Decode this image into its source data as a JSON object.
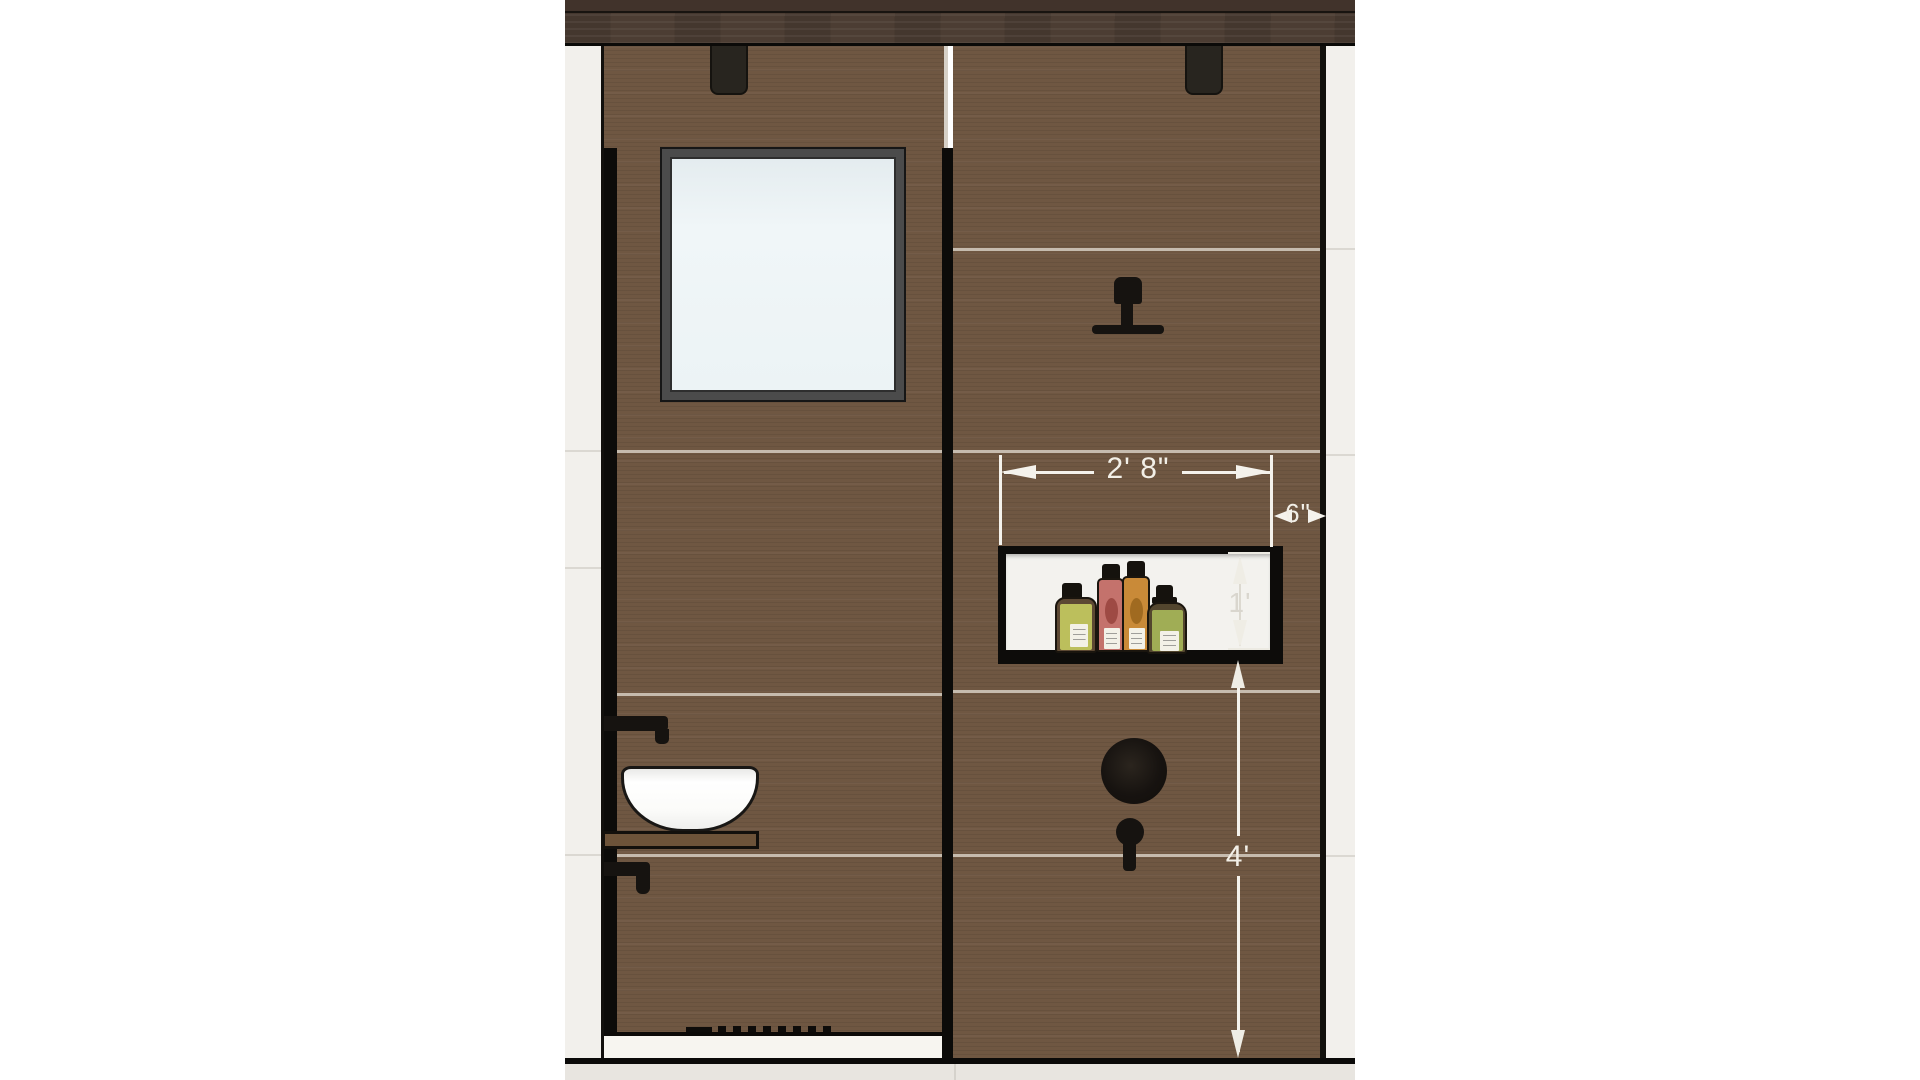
{
  "drawing": {
    "type": "bathroom shower wall elevation",
    "dimensions": {
      "niche_width": {
        "label": "2' 8\""
      },
      "niche_offset_right": {
        "label": "6\""
      },
      "niche_height": {
        "label": "1'"
      },
      "niche_bottom_to_floor": {
        "label": "4'"
      }
    },
    "colors": {
      "wall_tile": "#6f5742",
      "wood_beam": "#4c3d33",
      "side_tile": "#f2f0ec",
      "fixture_black": "#161310",
      "dimension_white": "#f4f2ec",
      "niche_interior": "#f3f2ee",
      "window_glass": "#ecf3f5",
      "floor": "#e8e5e0"
    },
    "fixtures": [
      "window",
      "ceiling-bracket-left",
      "ceiling-bracket-right",
      "rain-shower-head",
      "shower-valve",
      "diverter-knob",
      "shampoo-niche",
      "wall-faucet-upper",
      "vessel-basin",
      "wood-shelf",
      "wall-faucet-lower",
      "linear-drain"
    ],
    "bottles": [
      {
        "name": "olive-bottle",
        "body": "#5c4833",
        "cap": "#15120d",
        "label_bg": "#bcbf5c"
      },
      {
        "name": "rose-bottle",
        "body": "#c4726c",
        "cap": "#15120d",
        "label_bg": "#9e4a44"
      },
      {
        "name": "amber-bottle",
        "body": "#c98a38",
        "cap": "#15120d",
        "label_bg": "#a06a20"
      },
      {
        "name": "green-bottle",
        "body": "#53462e",
        "cap": "#15120d",
        "label_bg": "#a0ad55"
      }
    ]
  }
}
